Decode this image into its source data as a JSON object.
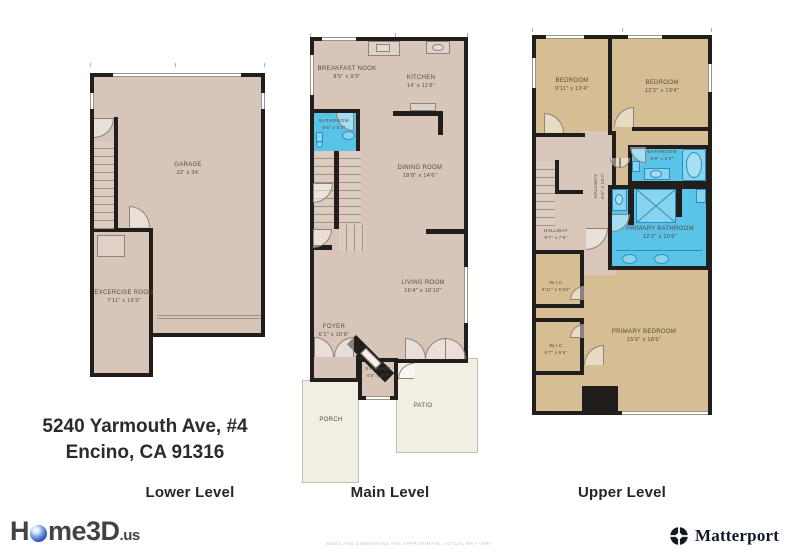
{
  "address": {
    "line1": "5240 Yarmouth Ave, #4",
    "line2": "Encino, CA 91316"
  },
  "levels": [
    {
      "label": "Lower Level",
      "rooms": [
        {
          "name": "GARAGE",
          "dims": "22' x 34'"
        },
        {
          "name": "EXCERCISE ROOM",
          "dims": "7'11\" x 19'3\""
        }
      ]
    },
    {
      "label": "Main Level",
      "rooms": [
        {
          "name": "BREAKFAST NOOK",
          "dims": "8'5\" x 9'3\""
        },
        {
          "name": "KITCHEN",
          "dims": "14' x 11'6\""
        },
        {
          "name": "BATHROOM",
          "dims": "6'6\" x 5'2\""
        },
        {
          "name": "DINING ROOM",
          "dims": "18'8\" x 14'6\""
        },
        {
          "name": "LIVING ROOM",
          "dims": "16'4\" x 16'10\""
        },
        {
          "name": "FOYER",
          "dims": "6'1\" x 16'6\""
        },
        {
          "name": "STORAGE",
          "dims": "4'8\" x 4'7\""
        },
        {
          "name": "PORCH",
          "dims": ""
        },
        {
          "name": "PATIO",
          "dims": ""
        }
      ]
    },
    {
      "label": "Upper Level",
      "rooms": [
        {
          "name": "BEDROOM",
          "dims": "9'11\" x 13'4\""
        },
        {
          "name": "BEDROOM",
          "dims": "12'2\" x 13'4\""
        },
        {
          "name": "BATHROOM",
          "dims": "8'9\" x 5'2\""
        },
        {
          "name": "HALLWAY",
          "dims": "6'6\" x 10'4\""
        },
        {
          "name": "HALLWAY",
          "dims": "6'7\" x 7'6\""
        },
        {
          "name": "PRIMARY BATHROOM",
          "dims": "12'2\" x 10'6\""
        },
        {
          "name": "W.I.C",
          "dims": "6'11\" x 5'10\""
        },
        {
          "name": "W.I.C",
          "dims": "6'7\" x 5'6\""
        },
        {
          "name": "PRIMARY BEDROOM",
          "dims": "15'6\" x 18'6\""
        }
      ]
    }
  ],
  "footer": {
    "home3d_prefix": "H",
    "home3d_rest": "me3D",
    "home3d_suffix": ".us",
    "matterport": "Matterport",
    "disclaimer": "SIZES AND DIMENSIONS ARE APPROXIMATE, ACTUAL MAY VARY"
  },
  "colors": {
    "wall": "#211e1c",
    "floor_tan": "#d7c5b9",
    "floor_khaki": "#d5bd94",
    "bathroom_blue": "#5ac3e8",
    "outdoor_cream": "#f1efe3"
  }
}
